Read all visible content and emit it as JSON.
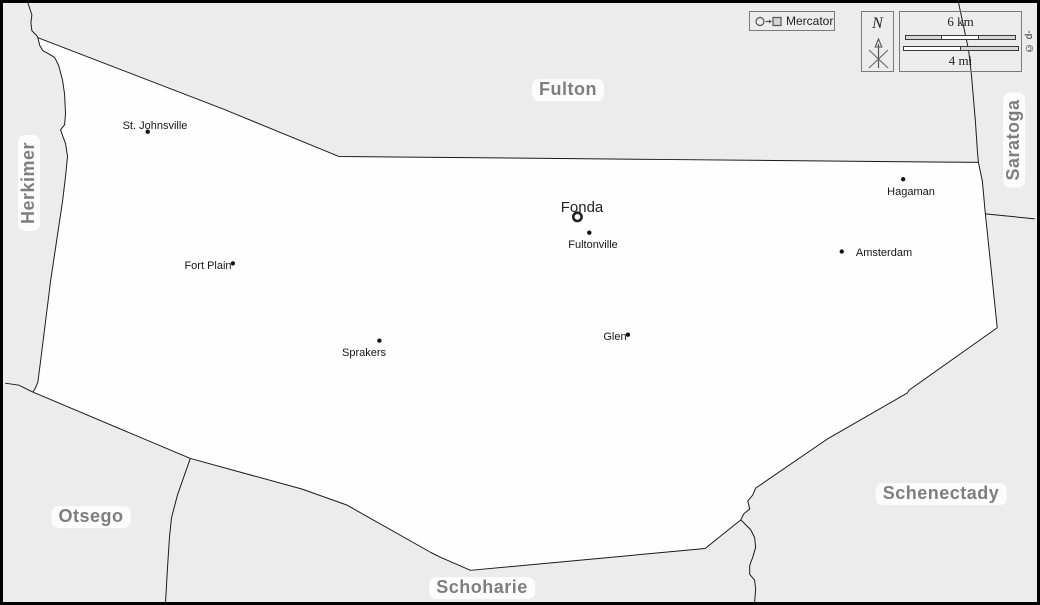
{
  "map": {
    "projection_label": "Mercator",
    "compass_label": "N",
    "scale_km_label": "6 km",
    "scale_mi_label": "4 mi",
    "copyright": "© d-maps.com",
    "colors": {
      "county_fill": "#fefefe",
      "neighbor_fill": "#ececec",
      "border_line": "#1a1a1a",
      "county_label": "#7e7e7e"
    }
  },
  "county_seat": {
    "name": "Fonda"
  },
  "counties": [
    {
      "name": "Fulton"
    },
    {
      "name": "Herkimer"
    },
    {
      "name": "Saratoga"
    },
    {
      "name": "Otsego"
    },
    {
      "name": "Schoharie"
    },
    {
      "name": "Schenectady"
    }
  ],
  "towns": [
    {
      "name": "St. Johnsville"
    },
    {
      "name": "Fort Plain"
    },
    {
      "name": "Sprakers"
    },
    {
      "name": "Fultonville"
    },
    {
      "name": "Glen"
    },
    {
      "name": "Hagaman"
    },
    {
      "name": "Amsterdam"
    }
  ]
}
